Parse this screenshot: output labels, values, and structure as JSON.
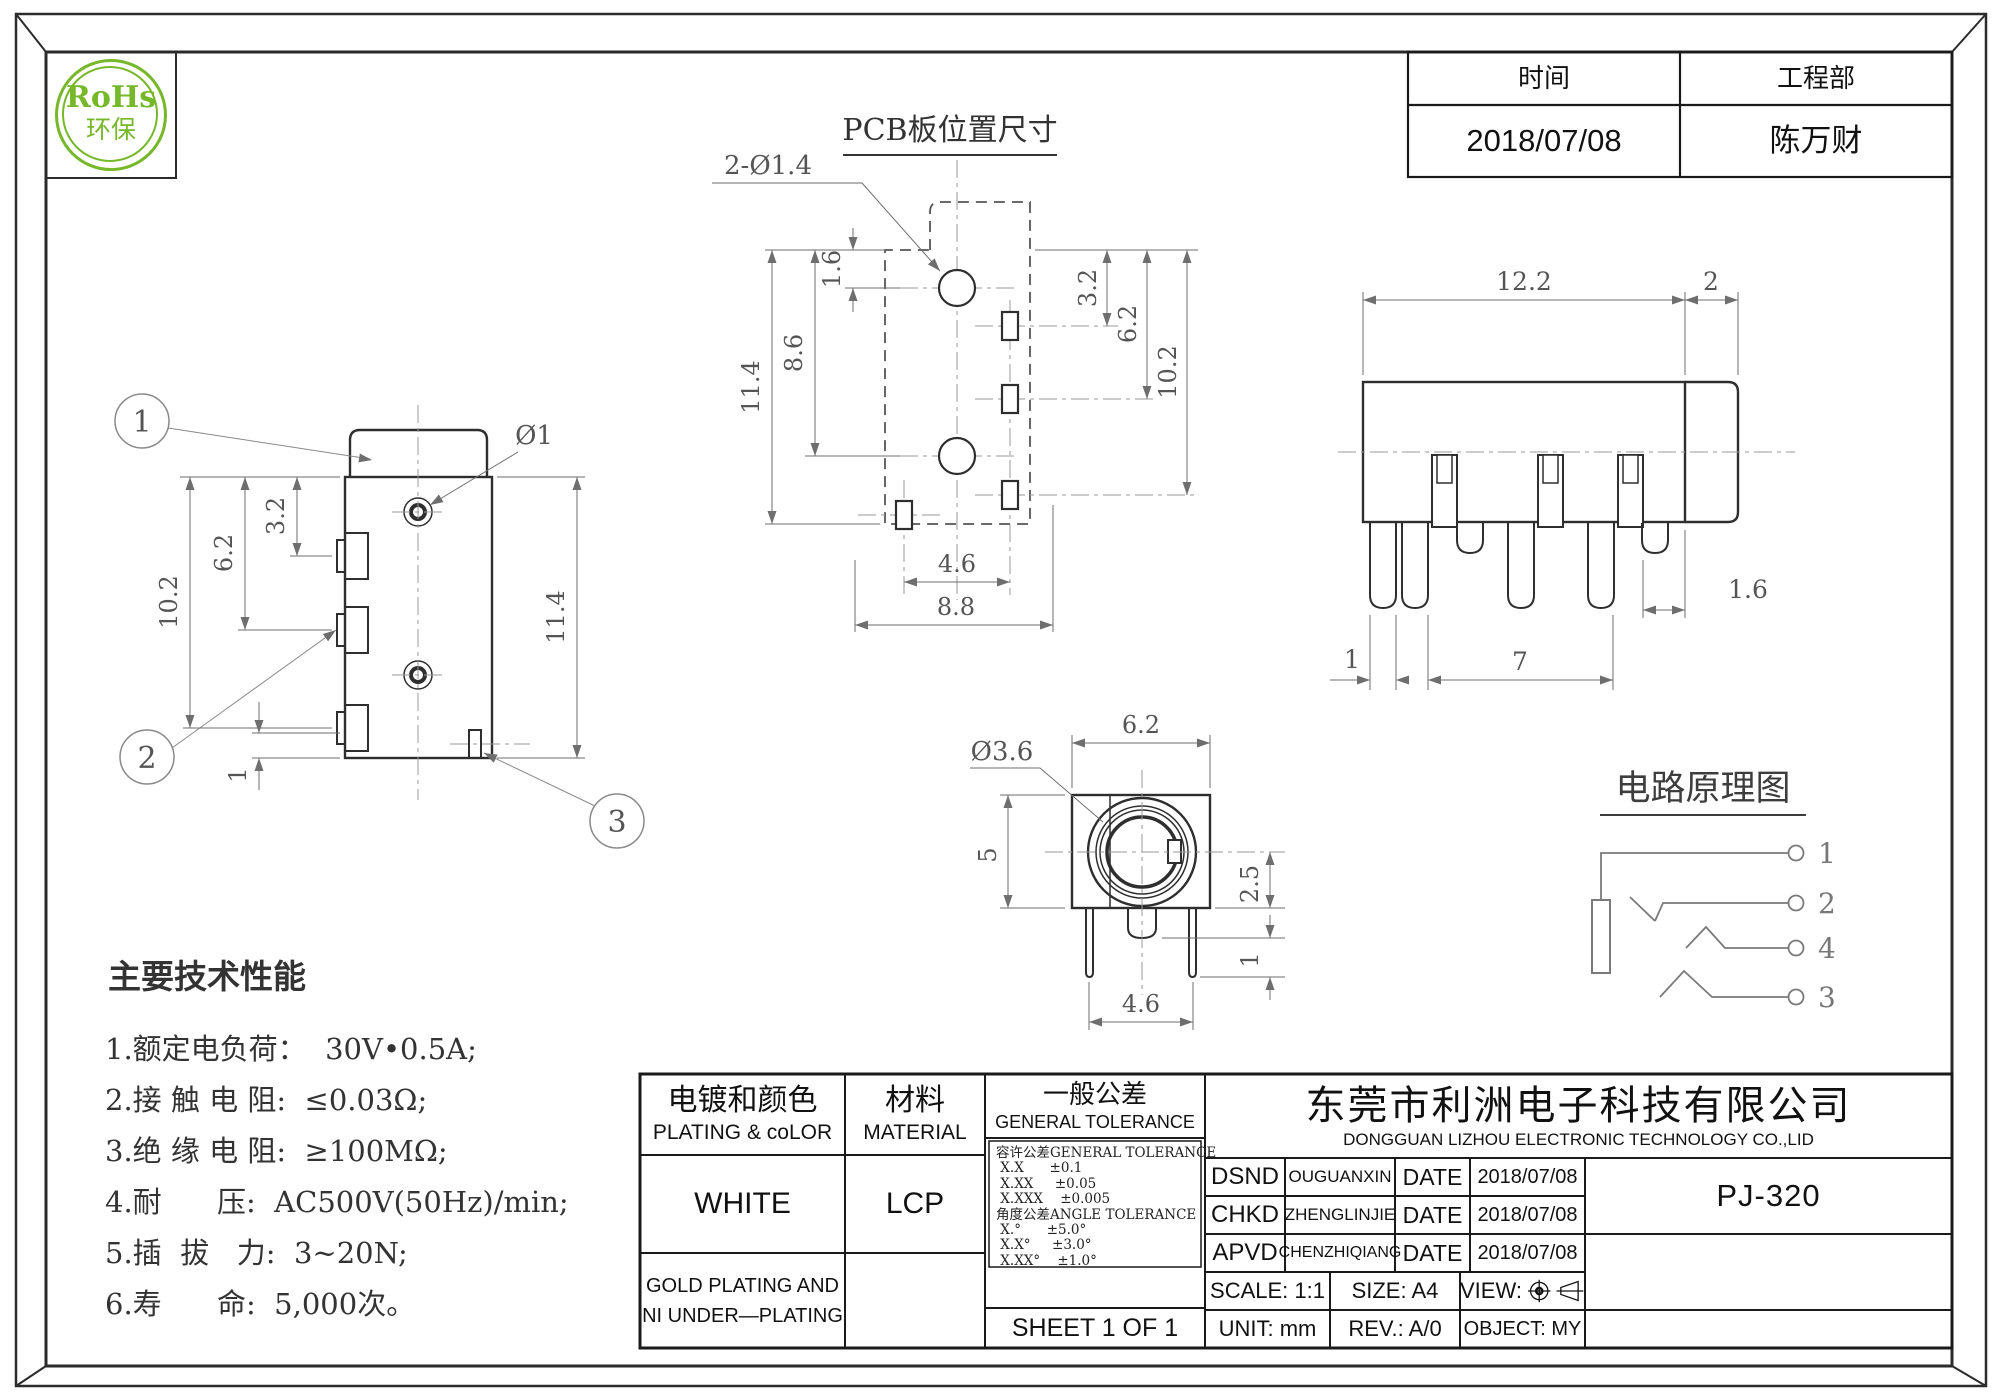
{
  "rohs": {
    "line1": "RoHs",
    "line2": "环保",
    "accent_color": "#76b82a"
  },
  "info": {
    "time_label": "时间",
    "dept_label": "工程部",
    "time_value": "2018/07/08",
    "dept_value": "陈万财"
  },
  "pcb": {
    "title": "PCB板位置尺寸",
    "hole_note": "2-Ø1.4",
    "dim_11_4": "11.4",
    "dim_8_6": "8.6",
    "dim_1_6": "1.6",
    "dim_3_2": "3.2",
    "dim_6_2": "6.2",
    "dim_10_2": "10.2",
    "dim_4_6": "4.6",
    "dim_8_8": "8.8"
  },
  "left_view": {
    "balloon_1": "1",
    "balloon_2": "2",
    "balloon_3": "3",
    "dim_3_2": "3.2",
    "dim_6_2": "6.2",
    "dim_10_2": "10.2",
    "dim_11_4": "11.4",
    "dim_phi1": "Ø1",
    "dim_1": "1"
  },
  "right_view": {
    "dim_12_2": "12.2",
    "dim_2": "2",
    "dim_1_6": "1.6",
    "dim_1": "1",
    "dim_7": "7"
  },
  "front_view": {
    "dim_6_2": "6.2",
    "dim_phi3_6": "Ø3.6",
    "dim_5": "5",
    "dim_2_5": "2.5",
    "dim_1": "1",
    "dim_4_6": "4.6"
  },
  "schematic": {
    "title": "电路原理图",
    "term_a": "1",
    "term_b": "2",
    "term_c": "4",
    "term_d": "3"
  },
  "specs": {
    "title": "主要技术性能",
    "items": [
      "1.额定电负荷：  30V•0.5A;",
      "2.接 触 电 阻:  ≤0.03Ω;",
      "3.绝 缘 电 阻:  ≥100MΩ;",
      "4.耐      压:  AC500V(50Hz)/min;",
      "5.插  拔   力:  3~20N;",
      "6.寿      命:  5,000次。"
    ]
  },
  "titleblock": {
    "plating_cn": "电镀和颜色",
    "plating_en": "PLATING & coLOR",
    "plating_value": "WHITE",
    "plating_note": [
      "GOLD PLATING AND",
      "NI UNDER—PLATING"
    ],
    "material_cn": "材料",
    "material_en": "MATERIAL",
    "material_value": "LCP",
    "tol_cn": "一般公差",
    "tol_en": "GENERAL TOLERANCE",
    "tol_lines": [
      "容许公差GENERAL TOLERANCE",
      " X.X      ±0.1",
      " X.XX     ±0.05",
      " X.XXX    ±0.005",
      "角度公差ANGLE TOLERANCE",
      " X.°      ±5.0°",
      " X.X°     ±3.0°",
      " X.XX°    ±1.0°"
    ],
    "sheet": "SHEET 1 OF 1",
    "company_cn": "东莞市利洲电子科技有限公司",
    "company_en": "DONGGUAN LIZHOU ELECTRONIC TECHNOLOGY CO.,LID",
    "signers": [
      {
        "role": "DSND",
        "name": "OUGUANXIN",
        "date_label": "DATE",
        "date": "2018/07/08"
      },
      {
        "role": "CHKD",
        "name": "ZHENGLINJIE",
        "date_label": "DATE",
        "date": "2018/07/08"
      },
      {
        "role": "APVD",
        "name": "CHENZHIQIANG",
        "date_label": "DATE",
        "date": "2018/07/08"
      }
    ],
    "part_number": "PJ-320",
    "scale": "SCALE: 1:1",
    "size": "SIZE: A4",
    "view_label": "VIEW:",
    "unit": "UNIT: mm",
    "rev": "REV.: A/0",
    "object": "OBJECT: MY"
  }
}
